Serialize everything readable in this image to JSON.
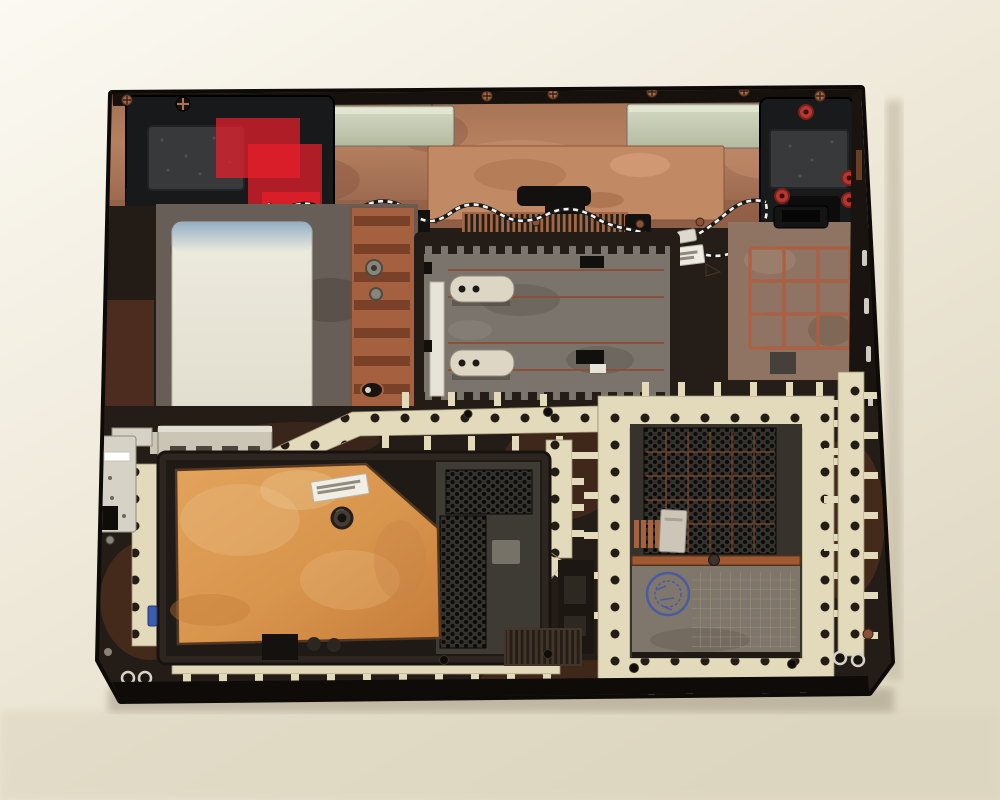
{
  "scene": {
    "caption": "Photograph of an opened laptop bottom case (interior view) lying on a cream tabletop",
    "background_color": "#efe9da",
    "colors": {
      "case_body": "#241d18",
      "case_rim": "#0e0b09",
      "copper_shield": "#b5805f",
      "bright_copper_plate": "#c28a64",
      "metal_rail": "#cdd1b8",
      "speaker_housing": "#18191b",
      "speaker_foam": "#37393a",
      "red_tape": "#ea1f2b",
      "rubber_grommet": "#b5372f",
      "antenna_wire_dark": "#191919",
      "antenna_wire_light": "#f2f2ee",
      "insulator_sheet": "#eceade",
      "insulator_blue_edge": "#89a9c2",
      "battery_bay": "#7b746c",
      "latch_cream": "#ddd6c4",
      "copper_grid_rib": "#ad5f42",
      "emi_gasket_cream": "#e3d9bb",
      "gasket_hole": "#241d15",
      "access_door_copper": "#d8954c",
      "mesh_panel": "#34322c",
      "stamped_panel": "#7f776b",
      "qc_stamp_blue": "#4558a8",
      "sticker_white": "#f1efe5",
      "bracket_silver": "#cbc5b6"
    },
    "parts": [
      {
        "name": "laptop-bottom-case"
      },
      {
        "name": "top-copper-emi-shield"
      },
      {
        "name": "left-speaker-module"
      },
      {
        "name": "right-speaker-module"
      },
      {
        "name": "red-plastic-tape"
      },
      {
        "name": "twisted-antenna-wire"
      },
      {
        "name": "white-insulator-sheet"
      },
      {
        "name": "battery-bay-with-latches"
      },
      {
        "name": "copper-grid-stiffener"
      },
      {
        "name": "emi-gasket-strips"
      },
      {
        "name": "copper-foil-access-door"
      },
      {
        "name": "hex-mesh-vents"
      },
      {
        "name": "stamped-panel-with-qc-stamp"
      },
      {
        "name": "barcode-stickers"
      }
    ]
  }
}
